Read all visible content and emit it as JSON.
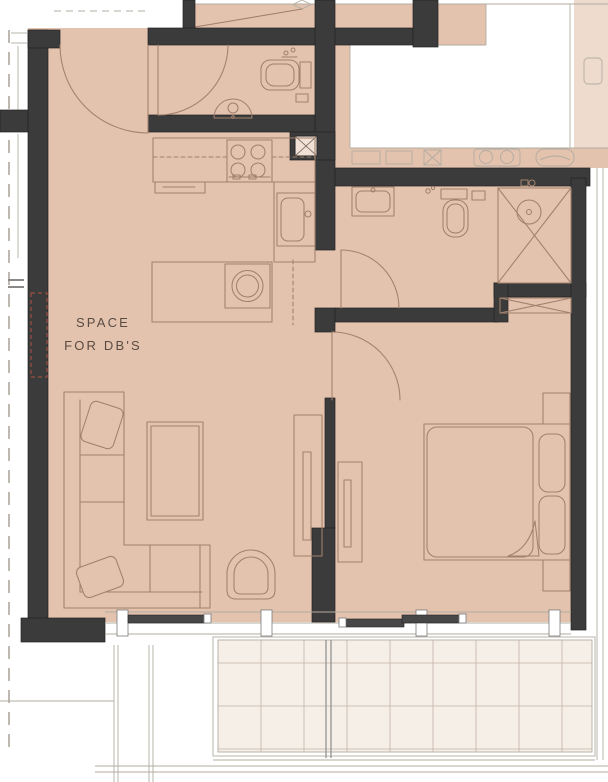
{
  "document": {
    "type": "architectural-floor-plan",
    "view": "apartment-unit-plan-with-balcony"
  },
  "labels": {
    "db_space_line1": "SPACE",
    "db_space_line2": "FOR DB'S"
  },
  "colors": {
    "wall": "#3b3b3b",
    "floor": "#e3c2ae",
    "floor_light": "#eedbce",
    "balcony_tile": "#f5efe8",
    "grid_line": "#c3b3a5",
    "furniture_line": "#a1806c",
    "outline_light": "#b3aca2",
    "text": "#5a4c42",
    "background": "#ffffff",
    "leaf": "#474747"
  }
}
